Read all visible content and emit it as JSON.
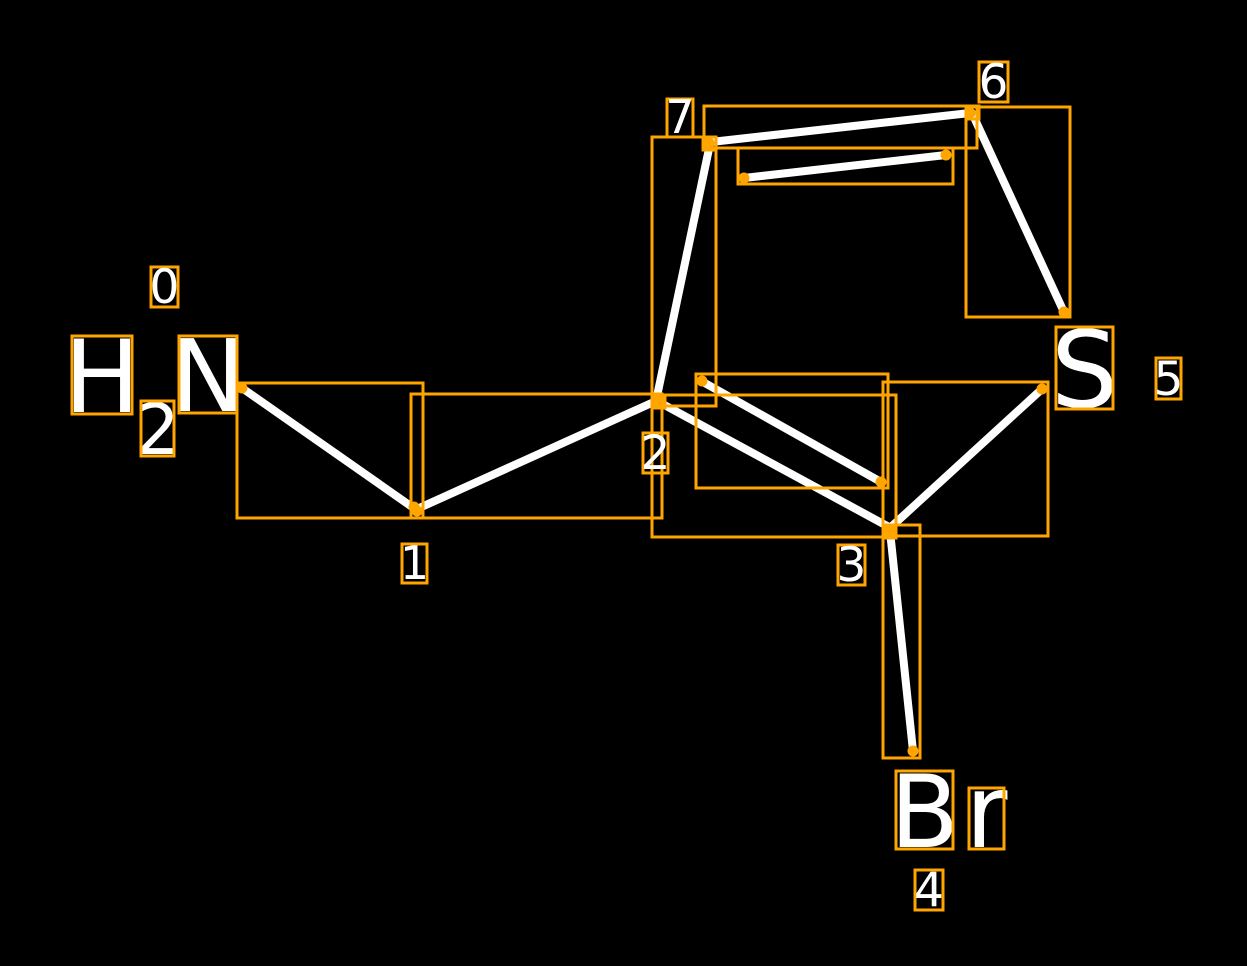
{
  "scene": {
    "width": 1247,
    "height": 966,
    "background_color": "#000000",
    "bond_color": "#ffffff",
    "annotation_color": "#ffa500",
    "text_color": "#ffffff",
    "bond_stroke_width": 8,
    "box_stroke_width": 3,
    "dot_radius": 5.5
  },
  "molecule": {
    "atom_symbols_shown": [
      "H",
      "2",
      "N",
      "S",
      "Br"
    ],
    "atom_indices_shown": [
      "0",
      "1",
      "2",
      "3",
      "4",
      "5",
      "6",
      "7"
    ]
  },
  "bonds": [
    {
      "name": "bond-0-1",
      "x1": 242,
      "y1": 388,
      "x2": 415,
      "y2": 509
    },
    {
      "name": "bond-1-2",
      "x1": 417,
      "y1": 509,
      "x2": 656,
      "y2": 401
    },
    {
      "name": "bond-2-7",
      "x1": 656,
      "y1": 401,
      "x2": 710,
      "y2": 144
    },
    {
      "name": "bond-7-6",
      "x1": 711,
      "y1": 142,
      "x2": 970,
      "y2": 113
    },
    {
      "name": "bond-7-6-inner",
      "x1": 744,
      "y1": 178,
      "x2": 946,
      "y2": 155
    },
    {
      "name": "bond-6-5",
      "x1": 972,
      "y1": 113,
      "x2": 1063,
      "y2": 310
    },
    {
      "name": "bond-5-3",
      "x1": 1042,
      "y1": 389,
      "x2": 891,
      "y2": 527
    },
    {
      "name": "bond-2-3",
      "x1": 657,
      "y1": 401,
      "x2": 889,
      "y2": 527
    },
    {
      "name": "bond-2-3-inner",
      "x1": 703,
      "y1": 382,
      "x2": 881,
      "y2": 482
    },
    {
      "name": "bond-3-4",
      "x1": 890,
      "y1": 531,
      "x2": 913,
      "y2": 751
    }
  ],
  "bond_boxes": [
    {
      "name": "bbox-bond-0-1",
      "x": 237,
      "y": 383,
      "w": 186,
      "h": 135
    },
    {
      "name": "bbox-bond-1-2",
      "x": 411,
      "y": 394,
      "w": 251,
      "h": 124
    },
    {
      "name": "bbox-bond-2-7",
      "x": 652,
      "y": 137,
      "w": 64,
      "h": 269
    },
    {
      "name": "bbox-bond-7-6",
      "x": 704,
      "y": 106,
      "w": 273,
      "h": 42
    },
    {
      "name": "bbox-bond-7-6-inner",
      "x": 738,
      "y": 148,
      "w": 215,
      "h": 36
    },
    {
      "name": "bbox-bond-6-5",
      "x": 966,
      "y": 107,
      "w": 104,
      "h": 210
    },
    {
      "name": "bbox-bond-5-3",
      "x": 883,
      "y": 382,
      "w": 165,
      "h": 154
    },
    {
      "name": "bbox-bond-2-3",
      "x": 652,
      "y": 395,
      "w": 244,
      "h": 142
    },
    {
      "name": "bbox-bond-2-3-inner",
      "x": 696,
      "y": 374,
      "w": 192,
      "h": 114
    },
    {
      "name": "bbox-bond-3-4",
      "x": 883,
      "y": 525,
      "w": 37,
      "h": 233
    }
  ],
  "atom_boxes": [
    {
      "name": "bbox-atom-2",
      "x": 652,
      "y": 395,
      "w": 13,
      "h": 13,
      "filled": true
    },
    {
      "name": "bbox-atom-3",
      "x": 883,
      "y": 525,
      "w": 13,
      "h": 13,
      "filled": true
    },
    {
      "name": "bbox-atom-6",
      "x": 966,
      "y": 106,
      "w": 13,
      "h": 13,
      "filled": false
    },
    {
      "name": "bbox-atom-7",
      "x": 703,
      "y": 137,
      "w": 13,
      "h": 13,
      "filled": false
    }
  ],
  "endpoint_dots": [
    {
      "name": "dot-bond0-n-end",
      "x": 242,
      "y": 388
    },
    {
      "name": "dot-atom1-a",
      "x": 414,
      "y": 507
    },
    {
      "name": "dot-atom1-b",
      "x": 417,
      "y": 511
    },
    {
      "name": "dot-atom2",
      "x": 657,
      "y": 401
    },
    {
      "name": "dot-inner23-left",
      "x": 702,
      "y": 381
    },
    {
      "name": "dot-inner23-right",
      "x": 881,
      "y": 482
    },
    {
      "name": "dot-atom7",
      "x": 709,
      "y": 143
    },
    {
      "name": "dot-inner76-left",
      "x": 744,
      "y": 178
    },
    {
      "name": "dot-inner76-right",
      "x": 946,
      "y": 155
    },
    {
      "name": "dot-atom6",
      "x": 970,
      "y": 113
    },
    {
      "name": "dot-bond65-s-end",
      "x": 1064,
      "y": 312
    },
    {
      "name": "dot-bond53-s-end",
      "x": 1042,
      "y": 389
    },
    {
      "name": "dot-atom3",
      "x": 890,
      "y": 530
    },
    {
      "name": "dot-bond34-br-end",
      "x": 913,
      "y": 751
    }
  ],
  "atom_labels": [
    {
      "name": "atom-symbol-H",
      "char": "H",
      "x": 72,
      "y": 336,
      "w": 60,
      "h": 78,
      "fs": 101
    },
    {
      "name": "atom-symbol-H2",
      "char": "2",
      "x": 141,
      "y": 401,
      "w": 33,
      "h": 55,
      "fs": 70
    },
    {
      "name": "atom-symbol-N",
      "char": "N",
      "x": 179,
      "y": 336,
      "w": 58,
      "h": 77,
      "fs": 100
    },
    {
      "name": "atom-symbol-S",
      "char": "S",
      "x": 1056,
      "y": 327,
      "w": 57,
      "h": 82,
      "fs": 106
    },
    {
      "name": "atom-symbol-B",
      "char": "B",
      "x": 896,
      "y": 771,
      "w": 57,
      "h": 78,
      "fs": 101
    },
    {
      "name": "atom-symbol-r",
      "char": "r",
      "x": 969,
      "y": 788,
      "w": 35,
      "h": 61,
      "fs": 102
    }
  ],
  "index_labels": [
    {
      "name": "index-label-0",
      "t": "0",
      "x": 151,
      "y": 267,
      "w": 27,
      "h": 40,
      "fs": 47
    },
    {
      "name": "index-label-1",
      "t": "1",
      "x": 402,
      "y": 544,
      "w": 25,
      "h": 39,
      "fs": 46
    },
    {
      "name": "index-label-2",
      "t": "2",
      "x": 643,
      "y": 433,
      "w": 25,
      "h": 40,
      "fs": 47
    },
    {
      "name": "index-label-3",
      "t": "3",
      "x": 838,
      "y": 545,
      "w": 27,
      "h": 40,
      "fs": 47
    },
    {
      "name": "index-label-4",
      "t": "4",
      "x": 915,
      "y": 870,
      "w": 28,
      "h": 40,
      "fs": 47
    },
    {
      "name": "index-label-5",
      "t": "5",
      "x": 1156,
      "y": 358,
      "w": 25,
      "h": 41,
      "fs": 47
    },
    {
      "name": "index-label-6",
      "t": "6",
      "x": 979,
      "y": 62,
      "w": 29,
      "h": 40,
      "fs": 47
    },
    {
      "name": "index-label-7",
      "t": "7",
      "x": 667,
      "y": 99,
      "w": 26,
      "h": 38,
      "fs": 46
    }
  ]
}
